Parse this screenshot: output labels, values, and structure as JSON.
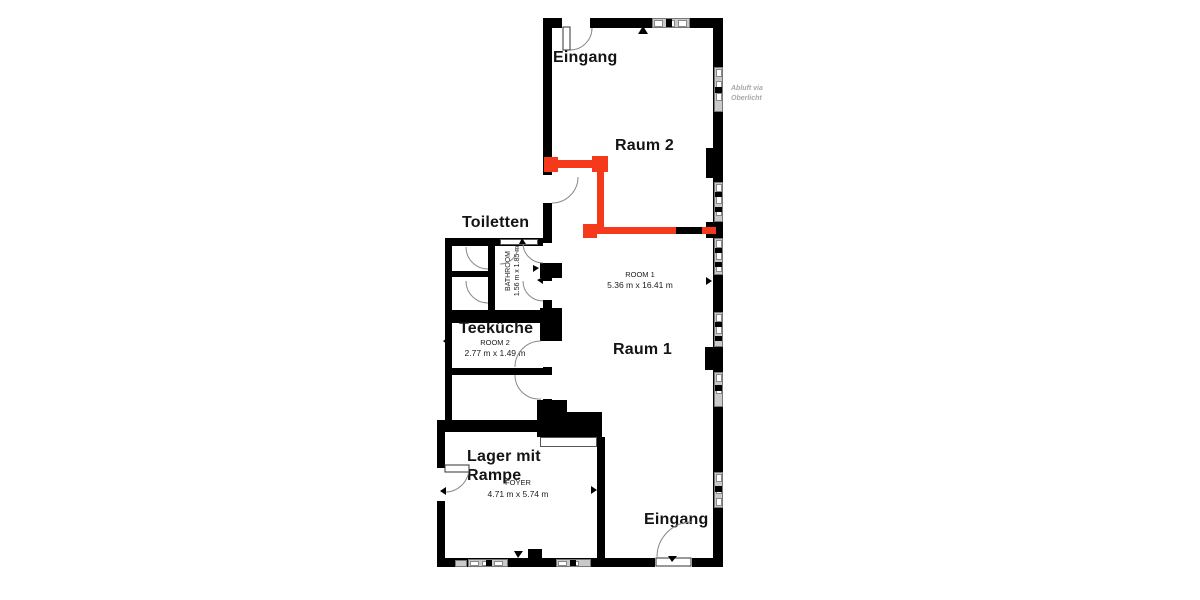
{
  "plan": {
    "entrances": {
      "top": "Eingang",
      "bottom": "Eingang"
    },
    "rooms": {
      "raum2": {
        "name": "Raum 2"
      },
      "raum1": {
        "name": "Raum 1",
        "alt": "ROOM 1",
        "dims": "5.36 m x 16.41 m"
      },
      "toiletten": {
        "name": "Toiletten",
        "alt": "BATHROOM",
        "dims": "1.56 m x 1.85 m"
      },
      "teekueche": {
        "name": "Teeküche",
        "alt": "ROOM 2",
        "dims": "2.77 m x 1.49 m"
      },
      "lager": {
        "name_line1": "Lager mit",
        "name_line2": "Rampe",
        "alt": "FOYER",
        "dims": "4.71 m x 5.74 m"
      }
    },
    "notes": {
      "vent_line1": "Abluft via",
      "vent_line2": "Oberlicht"
    },
    "colors": {
      "wall": "#000000",
      "partition_highlight": "#f5391b",
      "window_frame": "#c9c9c9",
      "note_text": "#a9a9a9"
    }
  }
}
